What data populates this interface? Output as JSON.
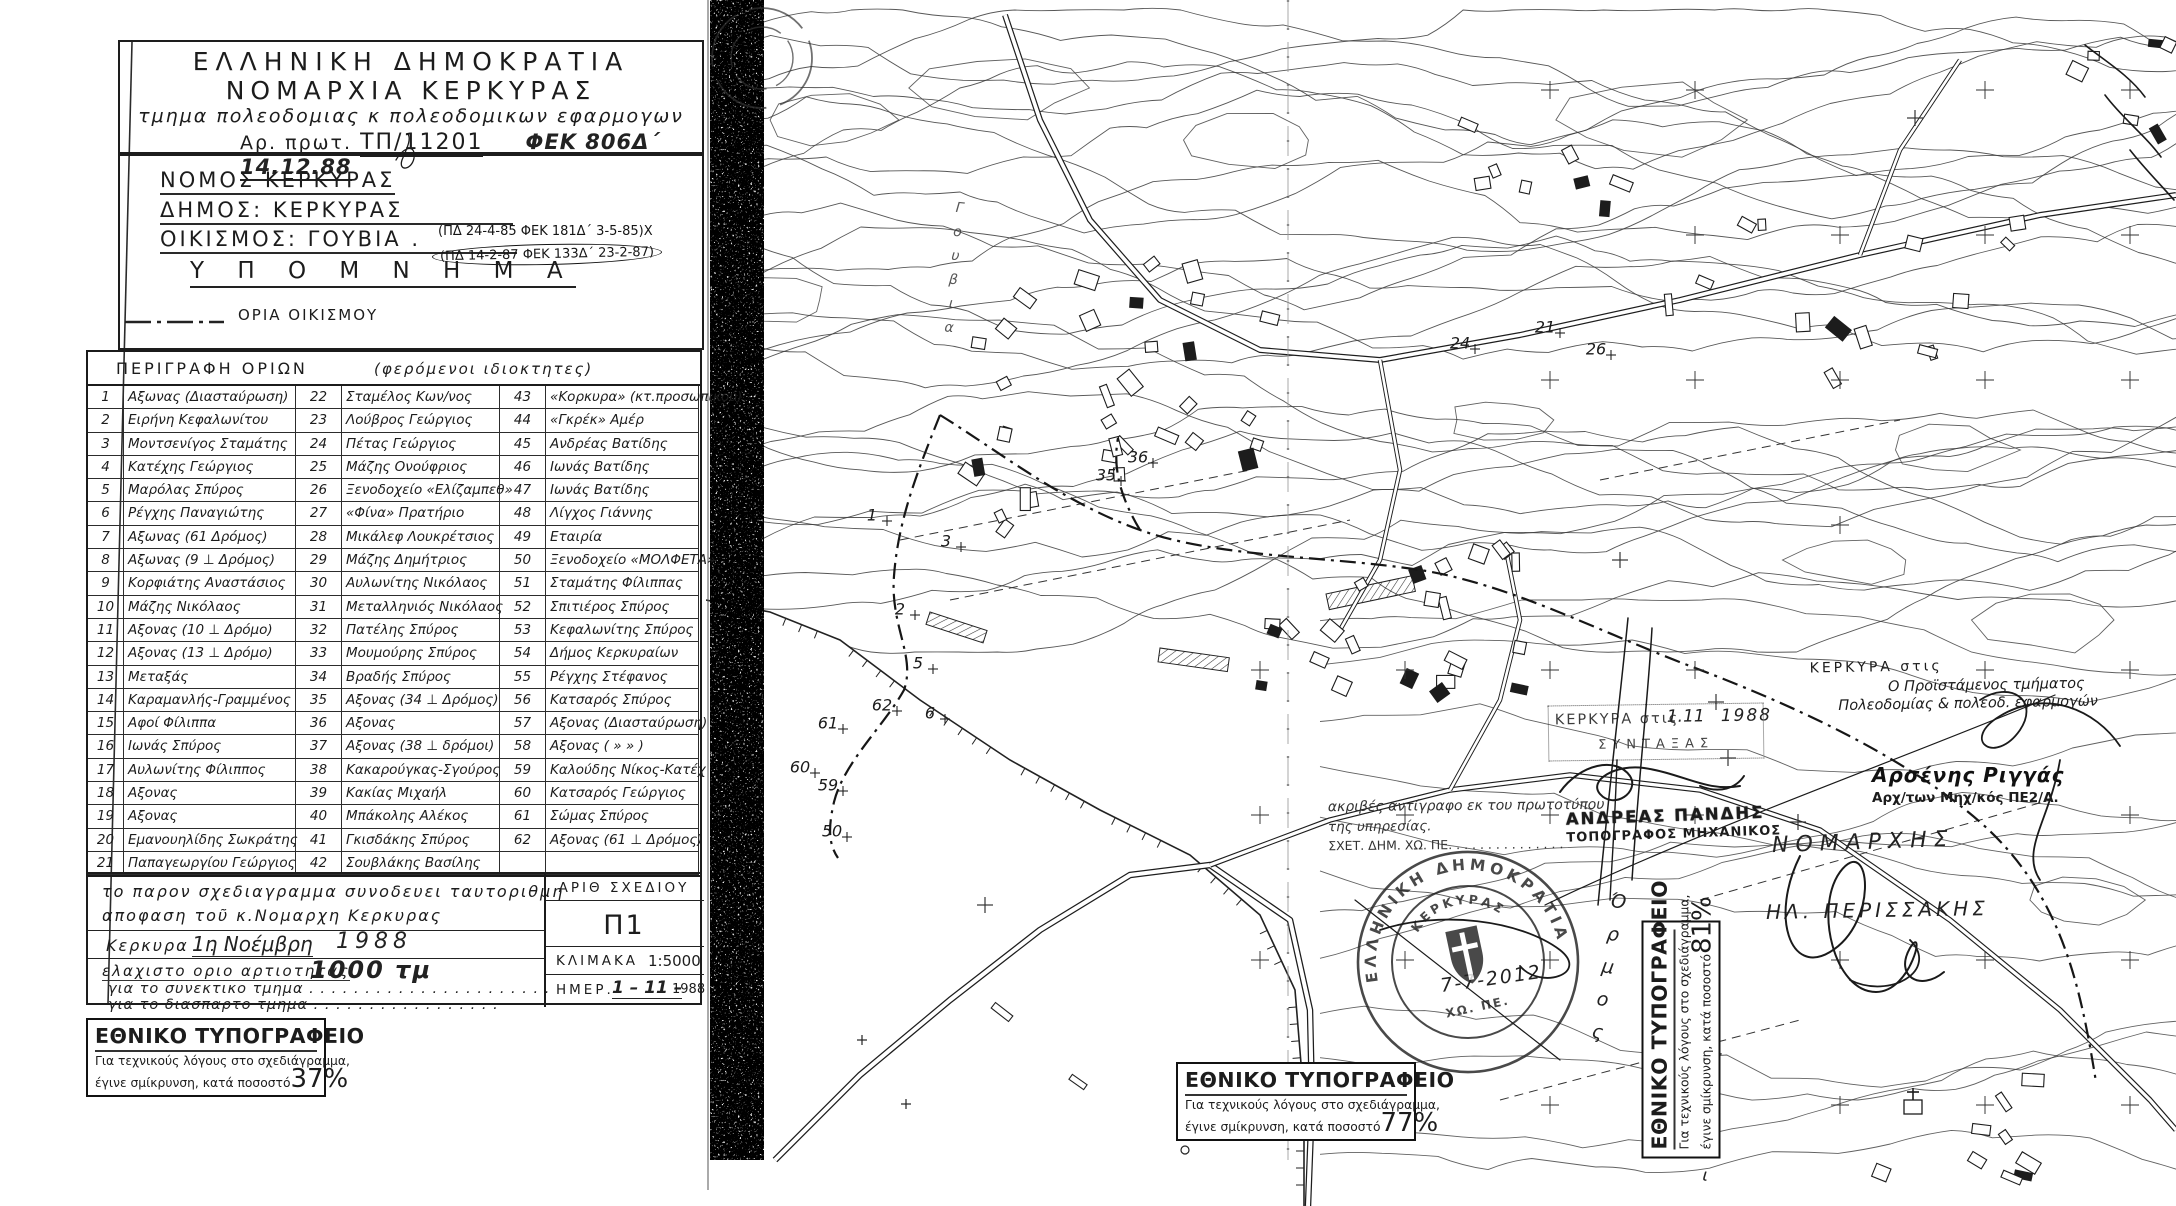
{
  "document": {
    "header": {
      "line1": "ΕΛΛΗΝΙΚΗ  ΔΗΜΟΚΡΑΤΙΑ",
      "line2": "ΝΟΜΑΡΧΙΑ  ΚΕΡΚΥΡΑΣ",
      "line3": "τμημα πολεοδομιας κ πολεοδομικων εφαρμογων",
      "protocol_label": "Αρ.  πρωτ.",
      "protocol_value": "ΤΠ/11201",
      "fek_note": "ΦΕΚ 806Δ΄ 14.12.88"
    },
    "ids": {
      "nomos": "ΝΟΜΟΣ ΚΕΡΚΥΡΑΣ",
      "dimos": "ΔΗΜΟΣ: ΚΕΡΚΥΡΑΣ",
      "oikismos": "ΟΙΚΙΣΜΟΣ: ΓΟΥΒΙΑ .",
      "pd1": "(ΠΔ 24-4-85  ΦΕΚ 181Δ΄ 3-5-85)Χ",
      "pd2": "(ΠΔ 14-2-87  ΦΕΚ 133Δ΄ 23-2-87)"
    },
    "legend": {
      "title": "Υ Π Ο Μ Ν Η Μ Α",
      "boundary_label": "ΟΡΙΑ ΟΙΚΙΣΜΟΥ"
    },
    "table": {
      "header_left": "ΠΕΡΙΓΡΑΦΗ  ΟΡΙΩΝ",
      "header_right": "(φερόμενοι  ιδιοκτητες)",
      "rows": [
        [
          "1",
          "Αξωνας (Διασταύρωση)",
          "22",
          "Σταμέλος Κων/νος",
          "43",
          "«Κορκυρα» (κτ.προσωπικού)"
        ],
        [
          "2",
          "Ειρήνη Κεφαλωνίτου",
          "23",
          "Λούβρος Γεώργιος",
          "44",
          "«Γκρέκ» Αμέρ"
        ],
        [
          "3",
          "Μοντσενίγος Σταμάτης",
          "24",
          "Πέτας Γεώργιος",
          "45",
          "Ανδρέας Βατίδης"
        ],
        [
          "4",
          "Κατέχης Γεώργιος",
          "25",
          "Μάζης Ονούφριος",
          "46",
          "Ιωνάς Βατίδης"
        ],
        [
          "5",
          "Μαρόλας Σπύρος",
          "26",
          "Ξενοδοχείο «Ελίζαμπεθ»",
          "47",
          "Ιωνάς Βατίδης"
        ],
        [
          "6",
          "Ρέγχης Παναγιώτης",
          "27",
          "«Φίνα» Πρατήριο",
          "48",
          "Λίγχος Γιάννης"
        ],
        [
          "7",
          "Αξωνας (61 Δρόμος)",
          "28",
          "Μικάλεφ Λουκρέτσιος",
          "49",
          "Εταιρία"
        ],
        [
          "8",
          "Αξωνας (9 ⊥ Δρόμος)",
          "29",
          "Μάζης Δημήτριος",
          "50",
          "Ξενοδοχείο «ΜΟΛΦΕΤΑ»"
        ],
        [
          "9",
          "Κορφιάτης Αναστάσιος",
          "30",
          "Αυλωνίτης Νικόλαος",
          "51",
          "Σταμάτης Φίλιππας"
        ],
        [
          "10",
          "Μάζης Νικόλαος",
          "31",
          "Μεταλληνιός Νικόλαος",
          "52",
          "Σπιτιέρος Σπύρος"
        ],
        [
          "11",
          "Αξονας (10 ⊥ Δρόμο)",
          "32",
          "Πατέλης Σπύρος",
          "53",
          "Κεφαλωνίτης Σπύρος"
        ],
        [
          "12",
          "Αξονας (13 ⊥ Δρόμο)",
          "33",
          "Μουμούρης Σπύρος",
          "54",
          "Δήμος Κερκυραίων"
        ],
        [
          "13",
          "Μεταξάς",
          "34",
          "Βραδής Σπύρος",
          "55",
          "Ρέγχης Στέφανος"
        ],
        [
          "14",
          "Καραμανλής-Γραμμένος",
          "35",
          "Αξονας (34 ⊥ Δρόμος)",
          "56",
          "Κατσαρός Σπύρος"
        ],
        [
          "15",
          "Αφοί Φίλιππα",
          "36",
          "Αξονας",
          "57",
          "Αξονας (Διασταύρωση)"
        ],
        [
          "16",
          "Ιωνάς Σπύρος",
          "37",
          "Αξονας (38 ⊥ δρόμοι)",
          "58",
          "Αξονας ( »  » )"
        ],
        [
          "17",
          "Αυλωνίτης Φίλιππος",
          "38",
          "Κακαρούγκας-Σγούρος",
          "59",
          "Καλούδης Νίκος-Κατέχ"
        ],
        [
          "18",
          "Αξονας",
          "39",
          "Κακίας Μιχαήλ",
          "60",
          "Κατσαρός Γεώργιος"
        ],
        [
          "19",
          "Αξονας",
          "40",
          "Μπάκολης Αλέκος",
          "61",
          "Σώμας Σπύρος"
        ],
        [
          "20",
          "Εμανουηλίδης Σωκράτης",
          "41",
          "Γκισδάκης Σπύρος",
          "62",
          "Αξονας (61 ⊥ Δρόμος)"
        ],
        [
          "21",
          "Παπαγεωργίου Γεώργιος",
          "42",
          "Σουβλάκης Βασίλης",
          "",
          ""
        ]
      ]
    },
    "notes": {
      "line1": "το παρον σχεδιαγραμμα  συνοδευει ταυτοριθμη",
      "line2": "αποφαση τοῦ κ.Νομαρχη Κερκυρας",
      "place": "Κερκυρα . . .",
      "date_hand": "1η Νοέμβρη",
      "year_hand": "1988",
      "min_label": "ελαχιστο οριο αρτιοτητας",
      "min_value": "1000 τμ",
      "syn_line": "για το συνεκτικο τμημα . . . . . . . . . . . . . . . . . . . . . .",
      "dia_line": "για το διασπαρτο τμημα . . . . . .  . . . . . . . .    . . ."
    },
    "plan_box": {
      "arith_label": "ΑΡΙΘ  ΣΧΕΔΙΟΥ",
      "arith_value": "Π1",
      "klimaka_label": "ΚΛΙΜΑΚΑ",
      "klimaka_value": "1:5000",
      "imer_label": "ΗΜΕΡ.",
      "imer_hand": "1 – 11 –",
      "imer_year": "1988"
    },
    "print_box": {
      "title": "ΕΘΝΙΚΟ ΤΥΠΟΓΡΑΦΕΙΟ",
      "line1": "Για τεχνικούς λόγους στο σχεδιάγραμμα,",
      "line2": "έγινε σμίκρυνση, κατά ποσοστό",
      "pct37": "37%",
      "pct77": "77%",
      "pct81": "81%"
    }
  },
  "map": {
    "stamps": {
      "kerkyra_date": {
        "label": "ΚΕΡΚΥΡΑ στις",
        "hand_date": "1.11",
        "hand_year": "1988",
        "syntaxas": "ΣΥΝΤΑΞΑΣ"
      },
      "proistamenos": {
        "line1": "ΚΕΡΚΥΡΑ στις",
        "line2": "Ο Προϊστάμενος τμήματος",
        "line3": "Πολεοδομίας & πολεοδ. εφαρμογών"
      },
      "riggas": {
        "name": "Αρσένης Ριγγάς",
        "title": "Αρχ/των Μηχ/κός ΠΕ2/Α."
      },
      "copy_note": {
        "line1": "ακριβές αντίγραφο εκ του πρωτοτύπου",
        "line2": "της υπηρεσίας.",
        "line3": "ΣΧΕΤ. ΔΗΜ. ΧΩ. ΠΕ. . . . . . . . . . . . . . ."
      },
      "pandis": {
        "name": "ΑΝΔΡΕΑΣ ΠΑΝΔΗΣ",
        "title": "ΤΟΠΟΓΡΑΦΟΣ ΜΗΧΑΝΙΚΟΣ"
      },
      "round_stamp": {
        "ring": "ΕΛΛΗΝΙΚΗ ΔΗΜΟΚΡΑΤΙΑ",
        "inner_top": "ΚΕΡΚΥΡΑΣ",
        "inner_bottom": "ΧΩ. ΠΕ."
      },
      "nomarxis": "ΝΟΜΑΡΧΗΣ",
      "perissakis": "ΗΛ. ΠΕΡΙΣΣΑΚΗΣ",
      "hand_note": "7-7-2012"
    },
    "labels": {
      "gouvia_top": "Γουβια",
      "ormos": "Όρμος",
      "gouvia_bottom": "Γουβι"
    },
    "boundary_points": [
      {
        "n": "1",
        "x": 872,
        "y": 516
      },
      {
        "n": "2",
        "x": 900,
        "y": 610
      },
      {
        "n": "3",
        "x": 946,
        "y": 542
      },
      {
        "n": "5",
        "x": 918,
        "y": 664
      },
      {
        "n": "6",
        "x": 930,
        "y": 714
      },
      {
        "n": "21",
        "x": 1545,
        "y": 328
      },
      {
        "n": "24",
        "x": 1460,
        "y": 344
      },
      {
        "n": "26",
        "x": 1596,
        "y": 350
      },
      {
        "n": "35",
        "x": 1106,
        "y": 476
      },
      {
        "n": "36",
        "x": 1138,
        "y": 458
      },
      {
        "n": "50",
        "x": 832,
        "y": 832
      },
      {
        "n": "59",
        "x": 828,
        "y": 786
      },
      {
        "n": "60",
        "x": 800,
        "y": 768
      },
      {
        "n": "61",
        "x": 828,
        "y": 724
      },
      {
        "n": "62",
        "x": 882,
        "y": 706
      }
    ]
  }
}
